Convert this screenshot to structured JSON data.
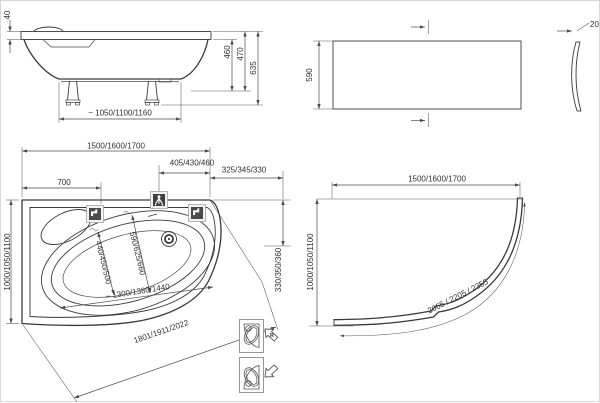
{
  "colors": {
    "background": "#ffffff",
    "line": "#3a3a3a",
    "dimension": "#4a4a4a",
    "icon_dark": "#4a4a4a",
    "icon_frame": "#a3a3a3",
    "icon_panel": "#f2f2f2",
    "pictogram_frame": "#8c8c8c"
  },
  "icons": {
    "tap_left": "faucet-icon",
    "tap_top": "mixer-tap-icon",
    "tap_right": "faucet-icon",
    "drain": "drain-icon",
    "orientation_right": "corner-tub-right-icon",
    "orientation_left": "corner-tub-left-icon"
  },
  "side_view": {
    "rim_thickness": "40",
    "height_inner": "460",
    "height_rim": "470",
    "height_total": "635",
    "leg_spacing": "~ 1050/1100/1160"
  },
  "front_panel": {
    "height": "590",
    "thickness": "20"
  },
  "plan_view": {
    "width": "1500/1600/1700",
    "mixer_offset": "405/430/460",
    "corner_offset": "325/345/330",
    "tap_offset": "700",
    "depth": "1000/1050/1100",
    "side_depth": "330/350/360",
    "inner_width_small": "440/450/500",
    "inner_width_large": "590/625/660",
    "inner_front_length": "~ 1300/1380/1440",
    "outer_front_length": "1801/1911/2022",
    "right_version_label": "R"
  },
  "panel_plan": {
    "width": "1500/1600/1700",
    "depth": "1000/1050/1100",
    "arc_length": "2065 / 2205 / 2355"
  }
}
